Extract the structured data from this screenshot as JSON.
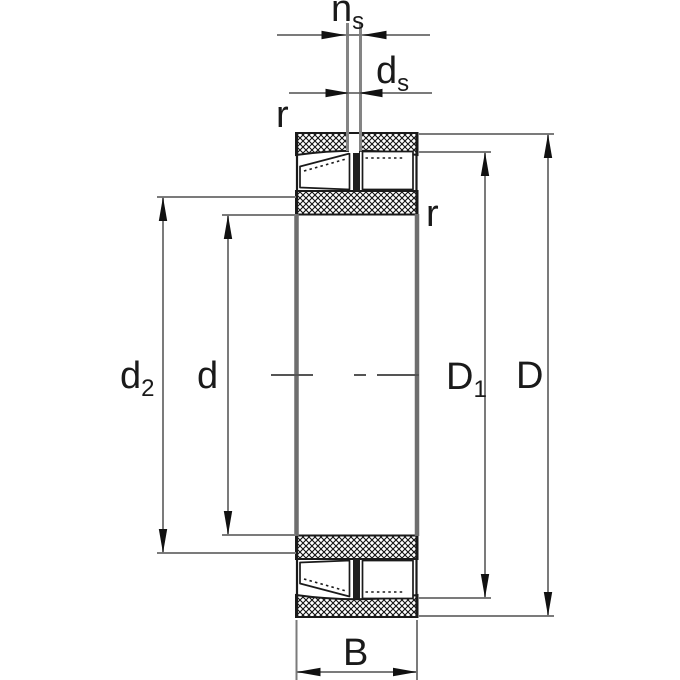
{
  "drawing": {
    "kind": "spherical-roller-bearing-cross-section",
    "labels": {
      "ns": {
        "base": "n",
        "sub": "s"
      },
      "ds": {
        "base": "d",
        "sub": "s"
      },
      "r_left": {
        "text": "r"
      },
      "r_right": {
        "text": "r"
      },
      "d2": {
        "base": "d",
        "sub": "2"
      },
      "d": {
        "text": "d"
      },
      "D1": {
        "base": "D",
        "sub": "1"
      },
      "D": {
        "text": "D"
      },
      "B": {
        "text": "B"
      }
    },
    "colors": {
      "outline": "#1a1a1a",
      "hatch": "#111111",
      "dimension_line": "#7b7b7b",
      "bore_edge": "#6e6e6e",
      "lube_hole_line": "#848484",
      "centerline": "#555555",
      "background": "#ffffff"
    }
  }
}
